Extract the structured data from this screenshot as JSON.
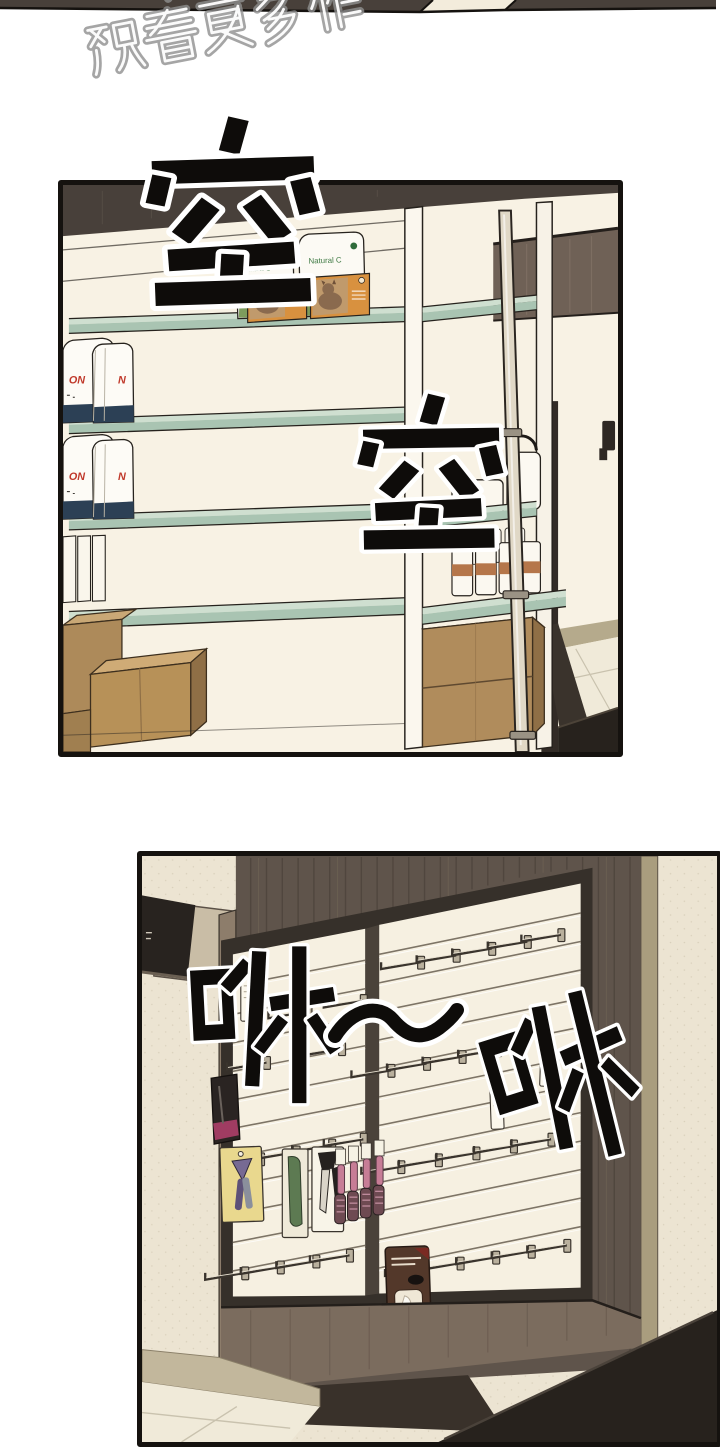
{
  "page": {
    "width": 720,
    "height": 1440,
    "background": "#ffffff",
    "kind": "webtoon comic page"
  },
  "previous_panel_strip": {
    "wood_color": "#48403a",
    "gap_color": "#f3ecdc"
  },
  "watermark": {
    "line1": "下载",
    "line2": "观看更多作",
    "full_text": "下载 观看更多作",
    "outline_color": "#8f8f8f"
  },
  "panel1": {
    "alt": "nearly empty pet-shop shelving unit with a few products and cardboard boxes",
    "sfx": [
      {
        "text": "空"
      },
      {
        "text": "空"
      }
    ],
    "products": {
      "natural_c_label": "Natural C",
      "bag_text_left": "ON",
      "bag_text_right": "N"
    },
    "colors": {
      "wall": "#f8f2e4",
      "wood_band": "#48403a",
      "glass_shelf": "#a9c4b2",
      "cardboard": "#b2905f",
      "bag_bottom": "#2c4055",
      "bag_text": "#c0392b",
      "cat_box": "#d8913f"
    }
  },
  "panel2": {
    "alt": "slatwall display with metal hooks, grooming tools and hanging packages",
    "sfx": [
      {
        "text": "咻"
      },
      {
        "text": "～"
      },
      {
        "text": "咻"
      }
    ],
    "colors": {
      "wall": "#ece4d2",
      "wood_panel": "#5f544b",
      "slat_board": "#f6f0e1",
      "frame": "#36302a",
      "hook_metal": "#b9b09d",
      "counter": "#27221d",
      "brush_pink": "#c77d96",
      "card_yellow": "#e9d88e"
    }
  }
}
